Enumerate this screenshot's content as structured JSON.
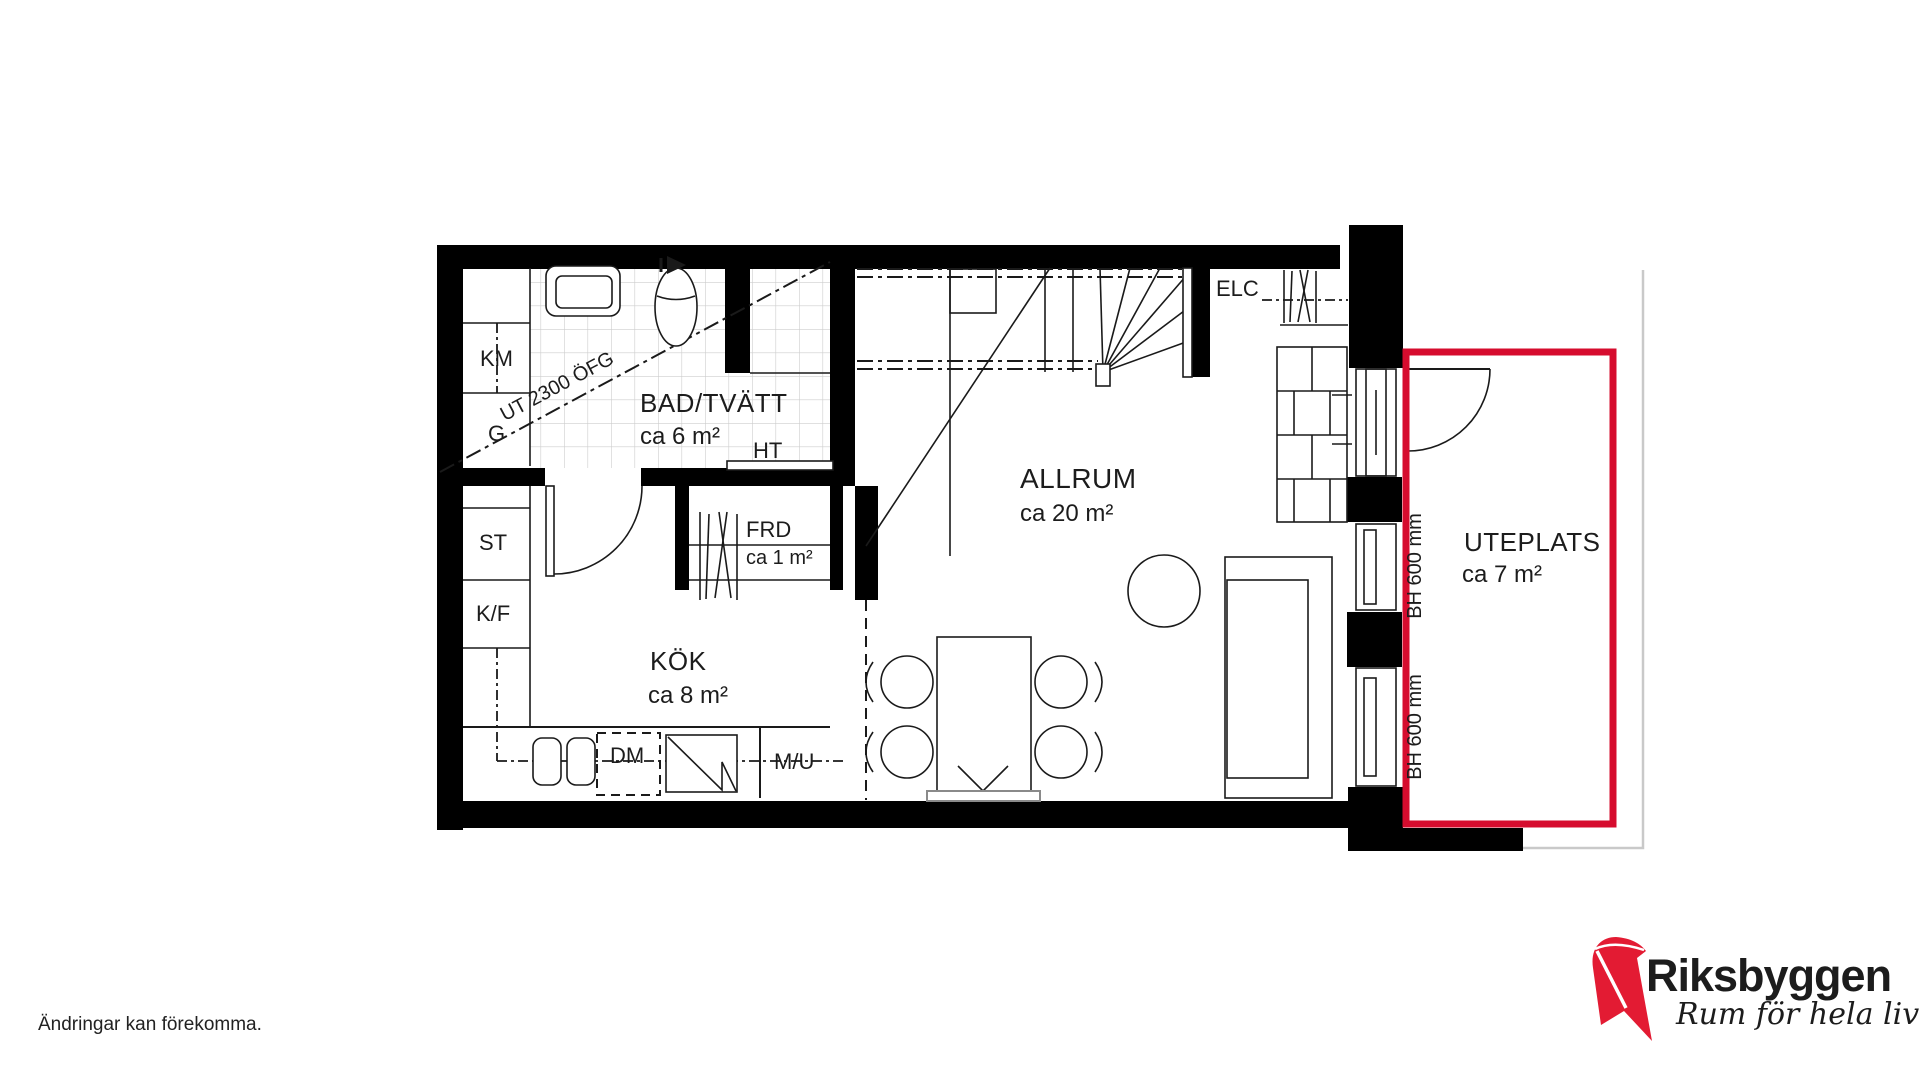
{
  "plan": {
    "rooms": {
      "bathroom": {
        "name": "BAD/TVÄTT",
        "area": "ca 6 m²"
      },
      "kitchen": {
        "name": "KÖK",
        "area": "ca 8 m²"
      },
      "living_room": {
        "name": "ALLRUM",
        "area": "ca 20 m²"
      },
      "storage": {
        "name": "FRD",
        "area": "ca 1 m²"
      },
      "patio": {
        "name": "UTEPLATS",
        "area": "ca 7 m²"
      }
    },
    "labels": {
      "washing_machine": "KM",
      "wardrobe": "G",
      "cleaning_cabinet": "ST",
      "fridge_freezer": "K/F",
      "dishwasher": "DM",
      "micro_oven": "M/U",
      "towel_dryer": "HT",
      "electrical_cabinet": "ELC",
      "ceiling_height": "UT 2300 ÖFG",
      "sill_height_upper": "BH 600 mm",
      "sill_height_lower": "BH 600 mm"
    }
  },
  "footer": {
    "disclaimer": "Ändringar kan förekomma."
  },
  "logo": {
    "brand": "Riksbyggen",
    "tagline": "Rum för hela livet"
  },
  "colors": {
    "patio_outline": "#d60c2e",
    "logo_red": "#e31b33",
    "logo_text_gray": "#9b9b9b",
    "wall": "#000000"
  }
}
